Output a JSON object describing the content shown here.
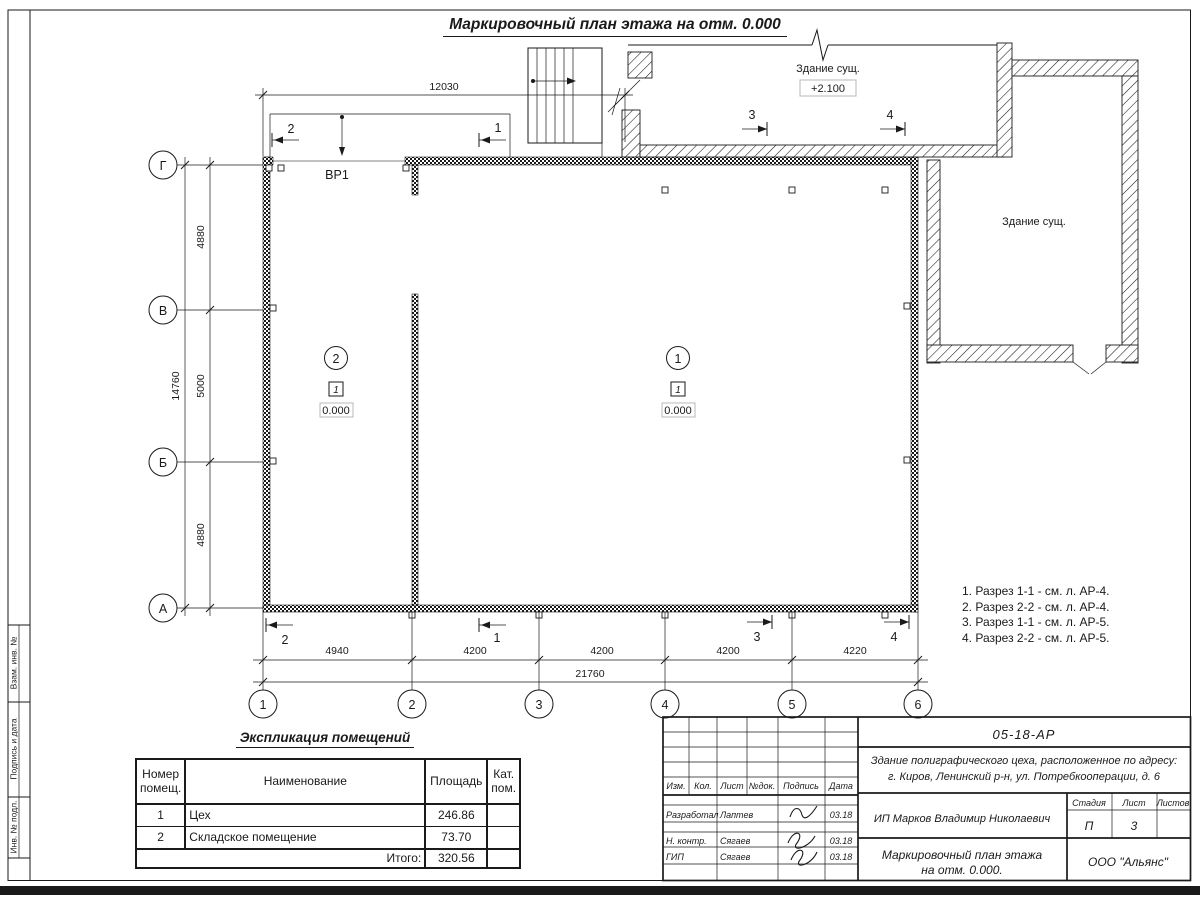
{
  "page_title": "Маркировочный план этажа на отм. 0.000",
  "side_strip": {
    "labels": [
      "Взам. инв. №",
      "Подпись и дата",
      "Инв. № подл."
    ]
  },
  "plan": {
    "gate_label": "ВР1",
    "existing_building_top": {
      "label": "Здание сущ.",
      "elevation": "+2.100"
    },
    "existing_building_right": {
      "label": "Здание сущ."
    },
    "room_markers": [
      {
        "number": "1",
        "category": "1",
        "elevation": "0.000"
      },
      {
        "number": "2",
        "category": "1",
        "elevation": "0.000"
      }
    ],
    "row_axes": [
      "Г",
      "В",
      "Б",
      "А"
    ],
    "col_axes": [
      "1",
      "2",
      "3",
      "4",
      "5",
      "6"
    ],
    "dims": {
      "top": "12030",
      "left": [
        "4880",
        "5000",
        "4880"
      ],
      "left_total": "14760",
      "bottom": [
        "4940",
        "4200",
        "4200",
        "4200",
        "4220"
      ],
      "bottom_total": "21760"
    },
    "sections": {
      "m1": "1",
      "m2": "2",
      "m3": "3",
      "m4": "4"
    }
  },
  "notes": [
    "1. Разрез 1-1 - см. л. АР-4.",
    "2. Разрез 2-2 - см. л. АР-4.",
    "3. Разрез 1-1 - см. л. АР-5.",
    "4. Разрез 2-2 - см. л. АР-5."
  ],
  "explication": {
    "title": "Экспликация помещений",
    "headers": {
      "number": "Номер помещ.",
      "name": "Наименование",
      "area": "Площадь",
      "category": "Кат. пом."
    },
    "rows": [
      {
        "number": "1",
        "name": "Цех",
        "area": "246.86",
        "category": ""
      },
      {
        "number": "2",
        "name": "Складское помещение",
        "area": "73.70",
        "category": ""
      }
    ],
    "total_label": "Итого:",
    "total_area": "320.56"
  },
  "title_block": {
    "doc_code": "05-18-АР",
    "object_line1": "Здание полиграфического цеха, расположенное по адресу:",
    "object_line2": "г. Киров, Ленинский р-н, ул. Потребкооперации, д. 6",
    "columns": {
      "izm": "Изм.",
      "kol": "Кол.",
      "list": "Лист",
      "ndok": "№док.",
      "podpis": "Подпись",
      "data": "Дата"
    },
    "roles": [
      {
        "role": "Разработал",
        "name": "Лаптев",
        "date": "03.18"
      },
      {
        "role": "Н. контр.",
        "name": "Сягаев",
        "date": "03.18"
      },
      {
        "role": "ГИП",
        "name": "Сягаев",
        "date": "03.18"
      }
    ],
    "client": "ИП Марков Владимир Николаевич",
    "stage_label": "Стадия",
    "sheet_label": "Лист",
    "sheets_label": "Листов",
    "stage": "П",
    "sheet_number": "3",
    "sheets_total": "",
    "sheet_title_line1": "Маркировочный план этажа",
    "sheet_title_line2": "на отм. 0.000.",
    "company": "ООО \"Альянс\""
  }
}
